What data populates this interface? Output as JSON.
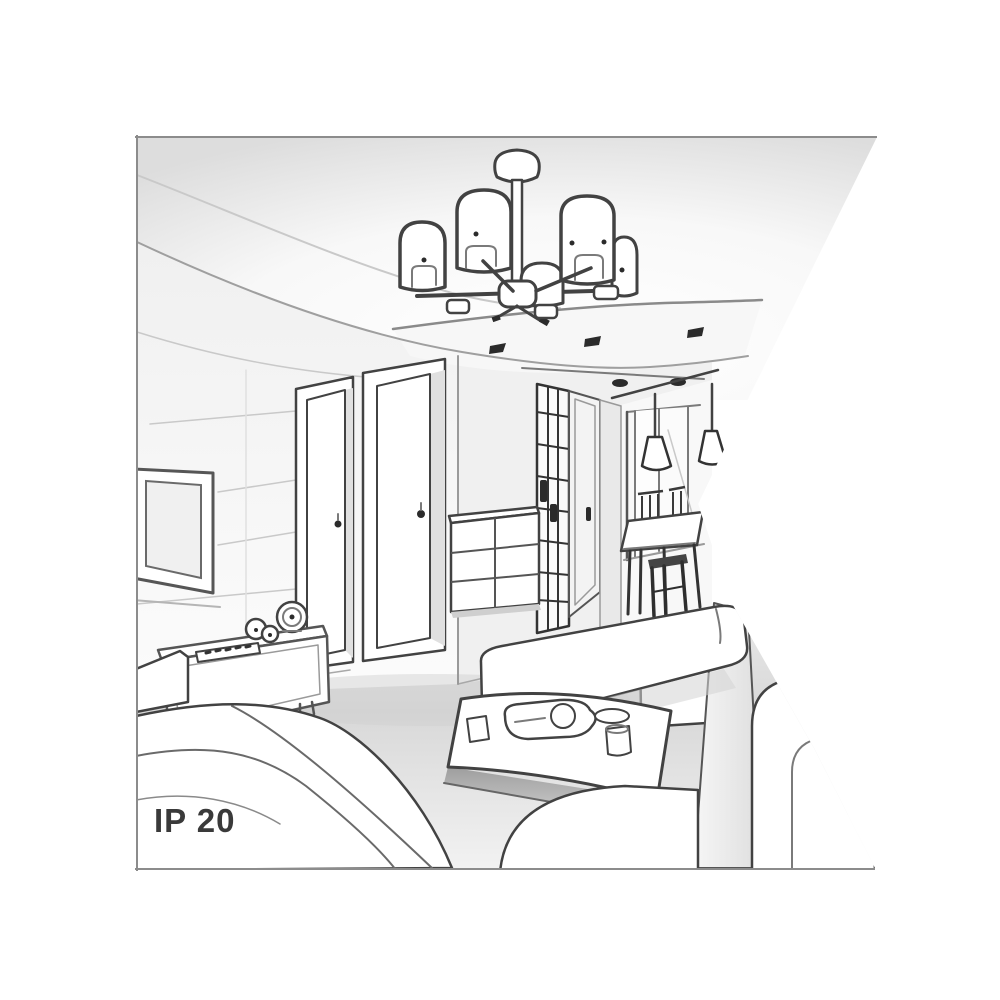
{
  "illustration": {
    "ip_rating_label": "IP 20"
  },
  "colors": {
    "background": "#ffffff",
    "border": "#8c8c8c",
    "line_dark": "#424242",
    "line_mid": "#7a7a7a",
    "line_light": "#c9c9c9",
    "fill_white": "#ffffff",
    "fill_light": "#f2f2f2",
    "fill_soft": "#f7f7f7",
    "fill_shadow": "#d5d5d5",
    "accent_dark": "#2b2b2b",
    "label_color": "#3a3a3a"
  }
}
